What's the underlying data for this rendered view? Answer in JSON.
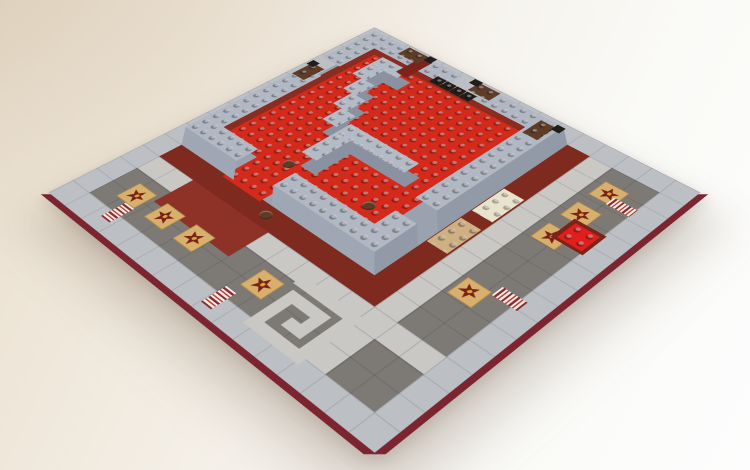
{
  "description": "Photograph of a LEGO square baseplate: raised red studded courtyard enclosed by light bluish-gray stud-topped walls with brown corner bricks and stepped gray baffles inside, surrounded at ground level by a dark gray tiled plaza with light gray path strips, tan star-printed tiles, red/white striped tiles, a greek-key spiral motif, maroon accent bands, on a warm white desk surface.",
  "palette": {
    "desk_warm": "#e9dfce",
    "desk_white": "#fdfdfd",
    "border_tile": "#bcbfc3",
    "plaza_tile": "#7d7975",
    "path_tile": "#c9c8c5",
    "maroon_skirt": "#7f2a1e",
    "maroon_patch": "#8e3126",
    "maroon_ring": "#8a2c20",
    "plate_edge": "#7c2531",
    "courtyard_red": "#d42a1b",
    "bright_red_plate": "#e01f1d",
    "wall_top": "#b1b8c4",
    "wall_face_sw": "#9fa7b4",
    "wall_face_se": "#9299a7",
    "wall_base": "#9aa2b0",
    "baffle_top": "#b4bbc7",
    "baffle_shadow": "#8a92a1",
    "star_tile_tan": "#d6b06c",
    "star_maroon": "#7b2016",
    "star_gold": "#d9a43c",
    "stripe_light": "#f1ede5",
    "stripe_maroon": "#8b2b31",
    "stripe_red": "#c03a30",
    "brown_brick": "#5f3c28",
    "black_piece": "#221d19",
    "cream_plate": "#eae3cc",
    "tan_plate": "#cfb083",
    "slope_maroon": "#7c241a"
  },
  "scene": {
    "plate_studs": 32,
    "elements": [
      {
        "t": "rect",
        "n": "plaza-tiles",
        "x": 2,
        "y": 2,
        "w": 28,
        "h": 28,
        "c": "#7d7975",
        "cls": "seams"
      },
      {
        "t": "rect",
        "n": "path-strip-horizontal",
        "x": 2,
        "y": 24,
        "w": 28,
        "h": 2,
        "c": "#c9c8c5",
        "cls": "seams"
      },
      {
        "t": "rect",
        "n": "path-strip-vertical",
        "x": 24,
        "y": 2,
        "w": 2,
        "h": 28,
        "c": "#c9c8c5",
        "cls": "seams"
      },
      {
        "t": "rect",
        "n": "maroon-skirt-south",
        "x": 2,
        "y": 22,
        "w": 22,
        "h": 2,
        "c": "#7f2a1e"
      },
      {
        "t": "rect",
        "n": "maroon-skirt-east",
        "x": 22,
        "y": 2,
        "w": 2,
        "h": 22,
        "c": "#7f2a1e"
      },
      {
        "t": "rect",
        "n": "maroon-entrance-plaza",
        "x": 6,
        "y": 24,
        "w": 8,
        "h": 3.4,
        "c": "#8e3126"
      },
      {
        "t": "spiral",
        "n": "spiral-path-motif",
        "x": 18.9,
        "y": 25.2,
        "w": 5.6,
        "h": 5.6,
        "c": "#c9c8c5"
      },
      {
        "t": "star",
        "n": "star-tile",
        "x": 3.6,
        "y": 26.9,
        "w": 2,
        "h": 2,
        "rot": 15
      },
      {
        "t": "star",
        "n": "star-tile",
        "x": 6.8,
        "y": 26.9,
        "w": 2,
        "h": 2,
        "rot": -10
      },
      {
        "t": "star",
        "n": "star-tile",
        "x": 10.0,
        "y": 26.9,
        "w": 2,
        "h": 2,
        "rot": 28
      },
      {
        "t": "star",
        "n": "star-tile",
        "x": 16.6,
        "y": 26.6,
        "w": 2,
        "h": 2,
        "rot": 5
      },
      {
        "t": "star",
        "n": "star-tile",
        "x": 26.6,
        "y": 3.6,
        "w": 2,
        "h": 2,
        "rot": -12
      },
      {
        "t": "star",
        "n": "star-tile",
        "x": 26.6,
        "y": 6.8,
        "w": 2,
        "h": 2,
        "rot": 20
      },
      {
        "t": "star",
        "n": "star-tile",
        "x": 26.6,
        "y": 10.0,
        "w": 2,
        "h": 2,
        "rot": -5
      },
      {
        "t": "star",
        "n": "star-tile",
        "x": 26.3,
        "y": 17.9,
        "w": 2,
        "h": 2,
        "rot": 32
      },
      {
        "t": "stripe",
        "n": "striped-tile",
        "x": 4.7,
        "y": 28.9,
        "w": 1,
        "h": 2,
        "dir": "y"
      },
      {
        "t": "stripe",
        "n": "striped-tile",
        "x": 16.1,
        "y": 29.3,
        "w": 1,
        "h": 2,
        "dir": "y"
      },
      {
        "t": "stripe",
        "n": "striped-tile",
        "x": 28.5,
        "y": 17.1,
        "w": 2,
        "h": 1,
        "dir": "x"
      },
      {
        "t": "stripe",
        "n": "striped-tile",
        "x": 28.1,
        "y": 4.7,
        "w": 2,
        "h": 1,
        "dir": "x"
      },
      {
        "t": "rect",
        "n": "maroon-inset-tile",
        "x": 27.6,
        "y": 8.5,
        "w": 2.6,
        "h": 2.6,
        "c": "#7c241a"
      },
      {
        "t": "rect",
        "n": "bright-red-plate-2x2",
        "x": 27.9,
        "y": 8.8,
        "w": 2,
        "h": 2,
        "c": "#e01f1d",
        "cls": "studs"
      },
      {
        "t": "rect",
        "n": "cream-plate-2x4",
        "x": 22.1,
        "y": 9.3,
        "w": 1.8,
        "h": 3.4,
        "c": "#eae3cc",
        "cls": "studs"
      },
      {
        "t": "rect",
        "n": "tan-plate-2x4",
        "x": 22.1,
        "y": 13.8,
        "w": 1.8,
        "h": 3.4,
        "c": "#cfb083",
        "cls": "studs"
      },
      {
        "t": "rect",
        "n": "brown-round-plate",
        "x": 12.1,
        "y": 22.5,
        "w": 0.9,
        "h": 0.9,
        "c": "#5f3c28",
        "cls": "round"
      },
      {
        "t": "rect",
        "n": "plate-edge-south",
        "x": 0.3,
        "y": 32,
        "w": 31.9,
        "h": 0.5,
        "c": "#7c2531",
        "tf": "skewX(-45deg)",
        "org": "50% 0%"
      },
      {
        "t": "rect",
        "n": "plate-edge-east",
        "x": 32,
        "y": 0.3,
        "w": 0.5,
        "h": 31.9,
        "c": "#7c2531",
        "tf": "skewY(-45deg)",
        "org": "0% 50%"
      },
      {
        "t": "rect",
        "n": "platform-base",
        "x": 2,
        "y": 2,
        "w": 20,
        "h": 20,
        "c": "#9aa2b0"
      },
      {
        "t": "rect",
        "n": "maroon-ring-northwest",
        "x": 2.3,
        "y": 2.3,
        "w": 1.1,
        "h": 19.4,
        "c": "#8a2c20"
      },
      {
        "t": "rect",
        "n": "maroon-ring-northeast",
        "x": 2.3,
        "y": 2.3,
        "w": 19.4,
        "h": 1.1,
        "c": "#8a2c20"
      },
      {
        "t": "rect",
        "n": "courtyard-floor",
        "x": 3.1,
        "y": 3.1,
        "w": 16,
        "h": 16,
        "c": "#d42a1b",
        "cls": "studs"
      },
      {
        "t": "rect",
        "n": "entrance-floor",
        "x": 7.1,
        "y": 19.1,
        "w": 4,
        "h": 3.2,
        "c": "#d42a1b",
        "cls": "studs"
      },
      {
        "t": "rect",
        "n": "wall-face-southwest-left",
        "x": 2,
        "y": 20.4,
        "w": 6,
        "h": 1.6,
        "c": "#9fa7b4",
        "tf": "skewX(45deg)",
        "org": "50% 100%"
      },
      {
        "t": "rect",
        "n": "wall-face-southwest-right",
        "x": 12,
        "y": 20.4,
        "w": 10,
        "h": 1.6,
        "c": "#9fa7b4",
        "tf": "skewX(45deg)",
        "org": "50% 100%"
      },
      {
        "t": "rect",
        "n": "wall-face-southeast-upper",
        "x": 20.4,
        "y": 2,
        "w": 1.6,
        "h": 14,
        "c": "#9299a7",
        "tf": "skewY(45deg)",
        "org": "100% 50%"
      },
      {
        "t": "rect",
        "n": "wall-face-southeast-lower",
        "x": 20.4,
        "y": 18,
        "w": 1.6,
        "h": 4,
        "c": "#9299a7",
        "tf": "skewY(45deg)",
        "org": "100% 50%"
      },
      {
        "t": "rect",
        "n": "wall-top-northwest-a",
        "x": 0.4,
        "y": 0.4,
        "w": 2,
        "h": 6,
        "c": "#b1b8c4",
        "cls": "studs"
      },
      {
        "t": "rect",
        "n": "wall-top-northwest-b",
        "x": 0.4,
        "y": 8.4,
        "w": 2,
        "h": 12,
        "c": "#b1b8c4",
        "cls": "studs"
      },
      {
        "t": "rect",
        "n": "wall-top-northeast-a",
        "x": 0.4,
        "y": 0.4,
        "w": 10,
        "h": 2,
        "c": "#b1b8c4",
        "cls": "studs"
      },
      {
        "t": "rect",
        "n": "wall-top-northeast-b",
        "x": 12.4,
        "y": 0.4,
        "w": 8,
        "h": 2,
        "c": "#b1b8c4",
        "cls": "studs"
      },
      {
        "t": "rect",
        "n": "wall-top-southeast-a",
        "x": 18.4,
        "y": 0.4,
        "w": 2,
        "h": 14,
        "c": "#b1b8c4",
        "cls": "studs"
      },
      {
        "t": "rect",
        "n": "wall-top-southeast-b",
        "x": 18.4,
        "y": 16.4,
        "w": 2,
        "h": 4,
        "c": "#b1b8c4",
        "cls": "studs"
      },
      {
        "t": "rect",
        "n": "wall-top-southwest-a",
        "x": 0.4,
        "y": 18.4,
        "w": 6,
        "h": 2,
        "c": "#b1b8c4",
        "cls": "studs"
      },
      {
        "t": "rect",
        "n": "wall-top-southwest-b",
        "x": 10.4,
        "y": 18.4,
        "w": 10,
        "h": 2,
        "c": "#b1b8c4",
        "cls": "studs"
      },
      {
        "t": "rect",
        "n": "baffle-shadow",
        "x": 5.1,
        "y": 4.1,
        "w": 3,
        "h": 1.5,
        "c": "#8a92a1"
      },
      {
        "t": "rect",
        "n": "baffle-shadow",
        "x": 5.1,
        "y": 5.6,
        "w": 1.5,
        "h": 2,
        "c": "#8a92a1"
      },
      {
        "t": "rect",
        "n": "baffle-shadow",
        "x": 6.1,
        "y": 7.6,
        "w": 1.5,
        "h": 2,
        "c": "#8a92a1"
      },
      {
        "t": "rect",
        "n": "baffle-shadow",
        "x": 7.1,
        "y": 9.6,
        "w": 1.5,
        "h": 2,
        "c": "#8a92a1"
      },
      {
        "t": "rect",
        "n": "baffle-shadow",
        "x": 8.1,
        "y": 11.6,
        "w": 1.5,
        "h": 2,
        "c": "#8a92a1"
      },
      {
        "t": "rect",
        "n": "baffle-shadow",
        "x": 10.1,
        "y": 12.6,
        "w": 7,
        "h": 1.5,
        "c": "#8a92a1"
      },
      {
        "t": "rect",
        "n": "baffle-shadow",
        "x": 10.1,
        "y": 14.1,
        "w": 1.5,
        "h": 3.5,
        "c": "#8a92a1"
      },
      {
        "t": "rect",
        "n": "baffle-wall-hook",
        "x": 3.9,
        "y": 2.9,
        "w": 3,
        "h": 1.5,
        "c": "#b4bbc7",
        "cls": "studs"
      },
      {
        "t": "rect",
        "n": "baffle-wall-step",
        "x": 3.9,
        "y": 4.4,
        "w": 1.5,
        "h": 2,
        "c": "#b4bbc7",
        "cls": "studs"
      },
      {
        "t": "rect",
        "n": "baffle-wall-step",
        "x": 4.9,
        "y": 6.4,
        "w": 1.5,
        "h": 2,
        "c": "#b4bbc7",
        "cls": "studs"
      },
      {
        "t": "rect",
        "n": "baffle-wall-step",
        "x": 5.9,
        "y": 8.4,
        "w": 1.5,
        "h": 2,
        "c": "#b4bbc7",
        "cls": "studs"
      },
      {
        "t": "rect",
        "n": "baffle-wall-step",
        "x": 6.9,
        "y": 10.4,
        "w": 1.5,
        "h": 2,
        "c": "#b4bbc7",
        "cls": "studs"
      },
      {
        "t": "rect",
        "n": "baffle-wall-run",
        "x": 8.9,
        "y": 11.4,
        "w": 7,
        "h": 1.5,
        "c": "#b4bbc7",
        "cls": "studs"
      },
      {
        "t": "rect",
        "n": "baffle-wall-return",
        "x": 8.9,
        "y": 12.9,
        "w": 1.5,
        "h": 3.5,
        "c": "#b4bbc7",
        "cls": "studs"
      },
      {
        "t": "rect",
        "n": "black-piece",
        "x": 9.0,
        "y": 1.9,
        "w": 1,
        "h": 1,
        "c": "#221d19",
        "cls": "studs"
      },
      {
        "t": "rect",
        "n": "black-piece",
        "x": 10.05,
        "y": 1.9,
        "w": 1,
        "h": 1,
        "c": "#221d19",
        "cls": "studs"
      },
      {
        "t": "rect",
        "n": "black-piece",
        "x": 11.1,
        "y": 1.9,
        "w": 1,
        "h": 1,
        "c": "#221d19",
        "cls": "studs"
      },
      {
        "t": "rect",
        "n": "black-piece",
        "x": 12.15,
        "y": 1.9,
        "w": 1,
        "h": 1,
        "c": "#221d19",
        "cls": "studs"
      },
      {
        "t": "rect",
        "n": "maroon-slope-piece",
        "x": 6.2,
        "y": 0.6,
        "w": 1.2,
        "h": 3.2,
        "c": "#7c241a",
        "tf": "skewY(8deg)",
        "org": "50% 50%"
      },
      {
        "t": "rect",
        "n": "brown-round-plate",
        "x": 8.9,
        "y": 17.6,
        "w": 0.9,
        "h": 0.9,
        "c": "#5f3c28",
        "cls": "round"
      },
      {
        "t": "rect",
        "n": "brown-round-plate",
        "x": 16.3,
        "y": 16.9,
        "w": 0.9,
        "h": 0.9,
        "c": "#5f3c28",
        "cls": "round"
      },
      {
        "t": "rect",
        "n": "brown-corner-brick",
        "x": 0.5,
        "y": 7.6,
        "w": 1.4,
        "h": 2.2,
        "c": "#5f3c28",
        "cls": "studs"
      },
      {
        "t": "rect",
        "n": "black-fitting",
        "x": 0.2,
        "y": 7.2,
        "w": 0.8,
        "h": 0.8,
        "c": "#221d19"
      },
      {
        "t": "rect",
        "n": "brown-corner-brick",
        "x": 4.4,
        "y": 0.3,
        "w": 2.2,
        "h": 1.4,
        "c": "#5f3c28",
        "cls": "studs"
      },
      {
        "t": "rect",
        "n": "black-fitting",
        "x": 6.5,
        "y": 0.1,
        "w": 0.8,
        "h": 0.8,
        "c": "#221d19"
      },
      {
        "t": "rect",
        "n": "brown-corner-brick",
        "x": 12.0,
        "y": 0.3,
        "w": 2.2,
        "h": 1.4,
        "c": "#5f3c28",
        "cls": "studs"
      },
      {
        "t": "rect",
        "n": "black-fitting",
        "x": 11.4,
        "y": 0.05,
        "w": 0.8,
        "h": 0.8,
        "c": "#221d19"
      },
      {
        "t": "rect",
        "n": "brown-corner-brick",
        "x": 18.7,
        "y": 0.9,
        "w": 1.4,
        "h": 2.2,
        "c": "#5f3c28",
        "cls": "studs"
      },
      {
        "t": "rect",
        "n": "black-fitting",
        "x": 19.9,
        "y": 0.5,
        "w": 0.8,
        "h": 0.8,
        "c": "#221d19"
      }
    ]
  }
}
